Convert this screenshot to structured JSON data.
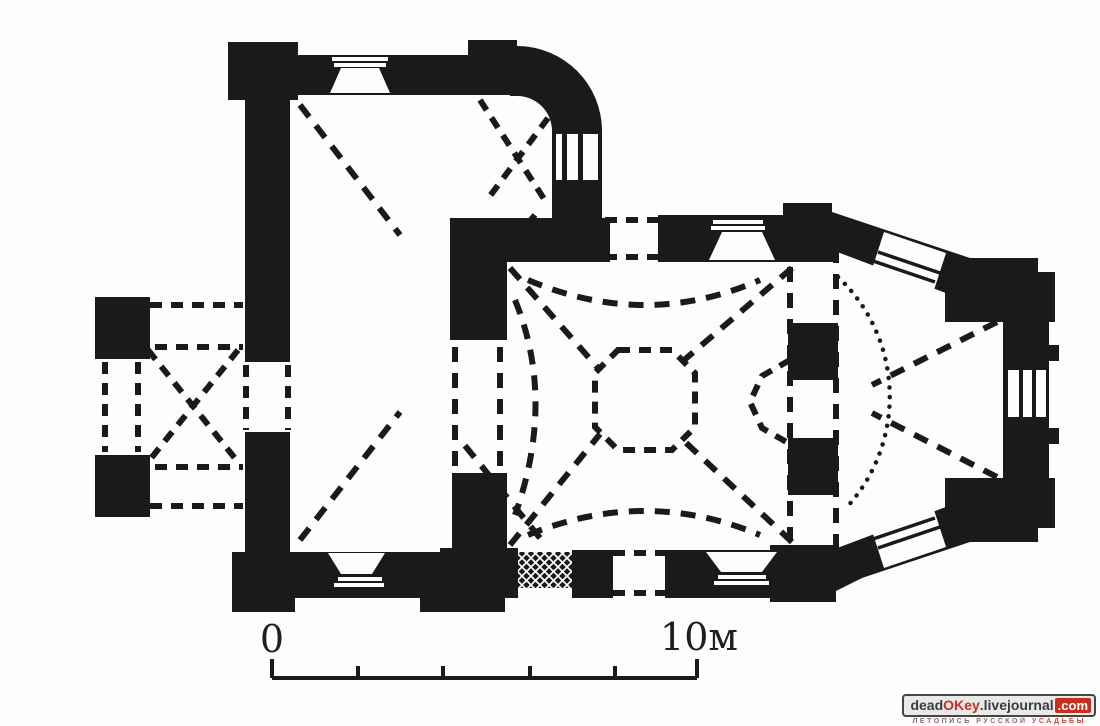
{
  "plan": {
    "ink_color": "#1a1a1a",
    "paper_color": "#fdfdfd",
    "drawing_type": "church floor plan"
  },
  "scale_bar": {
    "zero_label": "0",
    "max_label": "10м",
    "tick_count": 6
  },
  "watermark": {
    "site_part1": "dead",
    "site_part2": "OKey",
    "site_part3": ".livejournal",
    "site_part4": ".com",
    "tagline_part1": "ЛЕТОПИСЬ РУССКОЙ",
    "tagline_part2": "УСАДЬБЫ",
    "accent_color": "#c5301f",
    "box_bg_color": "#e9e9e9"
  }
}
